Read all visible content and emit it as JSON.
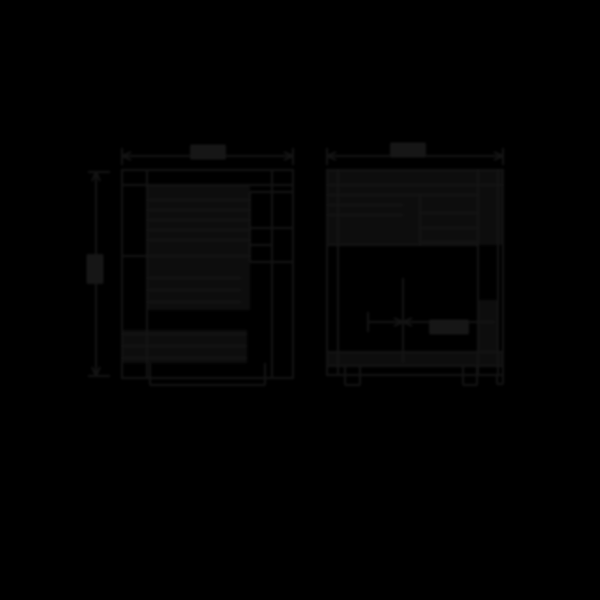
{
  "canvas": {
    "width": 600,
    "height": 600,
    "background": "#000000"
  },
  "style": {
    "line_color": "#141414",
    "line_width": 2,
    "blob_color": "#161616",
    "fill_color": "#0d0d0d",
    "blur_px": 1
  },
  "diagram": {
    "type": "technical-drawing",
    "views": [
      {
        "id": "front-view",
        "outer_rects": [
          [
            122,
            170,
            171,
            208
          ]
        ],
        "lines": [
          [
            147,
            170,
            147,
            378
          ],
          [
            272,
            170,
            272,
            378
          ],
          [
            250,
            192,
            250,
            262
          ],
          [
            250,
            192,
            293,
            192
          ],
          [
            250,
            228,
            293,
            228
          ],
          [
            250,
            245,
            272,
            245
          ],
          [
            250,
            262,
            293,
            262
          ],
          [
            147,
            200,
            250,
            200
          ],
          [
            147,
            210,
            250,
            210
          ],
          [
            147,
            220,
            250,
            220
          ],
          [
            147,
            230,
            250,
            230
          ],
          [
            147,
            240,
            250,
            240
          ],
          [
            122,
            256,
            250,
            256
          ],
          [
            147,
            278,
            241,
            278
          ],
          [
            147,
            290,
            241,
            290
          ],
          [
            147,
            302,
            241,
            302
          ],
          [
            122,
            334,
            247,
            334
          ],
          [
            122,
            346,
            247,
            346
          ],
          [
            122,
            358,
            247,
            358
          ],
          [
            122,
            185,
            293,
            185
          ],
          [
            150,
            363,
            150,
            385
          ],
          [
            265,
            363,
            265,
            385
          ],
          [
            150,
            385,
            265,
            385
          ],
          [
            122,
            156,
            293,
            156
          ],
          [
            122,
            148,
            122,
            165
          ],
          [
            293,
            148,
            293,
            165
          ],
          [
            122,
            156,
            131,
            152
          ],
          [
            122,
            156,
            131,
            160
          ],
          [
            293,
            156,
            284,
            152
          ],
          [
            293,
            156,
            284,
            160
          ],
          [
            96,
            172,
            96,
            376
          ],
          [
            88,
            172,
            110,
            172
          ],
          [
            88,
            376,
            110,
            376
          ],
          [
            96,
            172,
            92,
            181
          ],
          [
            96,
            172,
            100,
            181
          ],
          [
            96,
            376,
            92,
            367
          ],
          [
            96,
            376,
            100,
            367
          ]
        ],
        "fills": [
          [
            147,
            186,
            103,
            124
          ],
          [
            147,
            266,
            94,
            44
          ],
          [
            122,
            330,
            125,
            33
          ]
        ],
        "label_blobs": [
          [
            208,
            152,
            36,
            15
          ],
          [
            95,
            269,
            17,
            30
          ]
        ]
      },
      {
        "id": "side-view",
        "outer_rects": [
          [
            327,
            170,
            176,
            205
          ]
        ],
        "lines": [
          [
            338,
            170,
            338,
            375
          ],
          [
            478,
            170,
            478,
            375
          ],
          [
            498,
            170,
            498,
            375
          ],
          [
            420,
            195,
            420,
            245
          ],
          [
            403,
            278,
            403,
            363
          ],
          [
            327,
            185,
            503,
            185
          ],
          [
            327,
            195,
            478,
            195
          ],
          [
            327,
            205,
            403,
            205
          ],
          [
            327,
            215,
            403,
            215
          ],
          [
            420,
            213,
            478,
            213
          ],
          [
            420,
            228,
            478,
            228
          ],
          [
            420,
            242,
            478,
            242
          ],
          [
            327,
            245,
            478,
            245
          ],
          [
            327,
            352,
            503,
            352
          ],
          [
            327,
            366,
            503,
            366
          ],
          [
            345,
            366,
            345,
            385
          ],
          [
            360,
            366,
            360,
            385
          ],
          [
            345,
            385,
            360,
            385
          ],
          [
            463,
            366,
            463,
            385
          ],
          [
            477,
            366,
            477,
            385
          ],
          [
            463,
            385,
            477,
            385
          ],
          [
            497,
            375,
            497,
            384
          ],
          [
            503,
            375,
            503,
            384
          ],
          [
            497,
            384,
            503,
            384
          ],
          [
            368,
            322,
            495,
            322
          ],
          [
            368,
            312,
            368,
            332
          ],
          [
            403,
            322,
            394,
            318
          ],
          [
            403,
            322,
            394,
            326
          ],
          [
            403,
            322,
            412,
            318
          ],
          [
            403,
            322,
            412,
            326
          ],
          [
            327,
            156,
            503,
            156
          ],
          [
            327,
            148,
            327,
            165
          ],
          [
            503,
            148,
            503,
            165
          ],
          [
            327,
            156,
            336,
            152
          ],
          [
            327,
            156,
            336,
            160
          ],
          [
            503,
            156,
            494,
            152
          ],
          [
            503,
            156,
            494,
            160
          ]
        ],
        "fills": [
          [
            327,
            171,
            176,
            74
          ],
          [
            478,
            300,
            20,
            66
          ],
          [
            327,
            352,
            176,
            14
          ]
        ],
        "label_blobs": [
          [
            408,
            150,
            36,
            15
          ],
          [
            449,
            327,
            40,
            15
          ]
        ]
      }
    ]
  }
}
